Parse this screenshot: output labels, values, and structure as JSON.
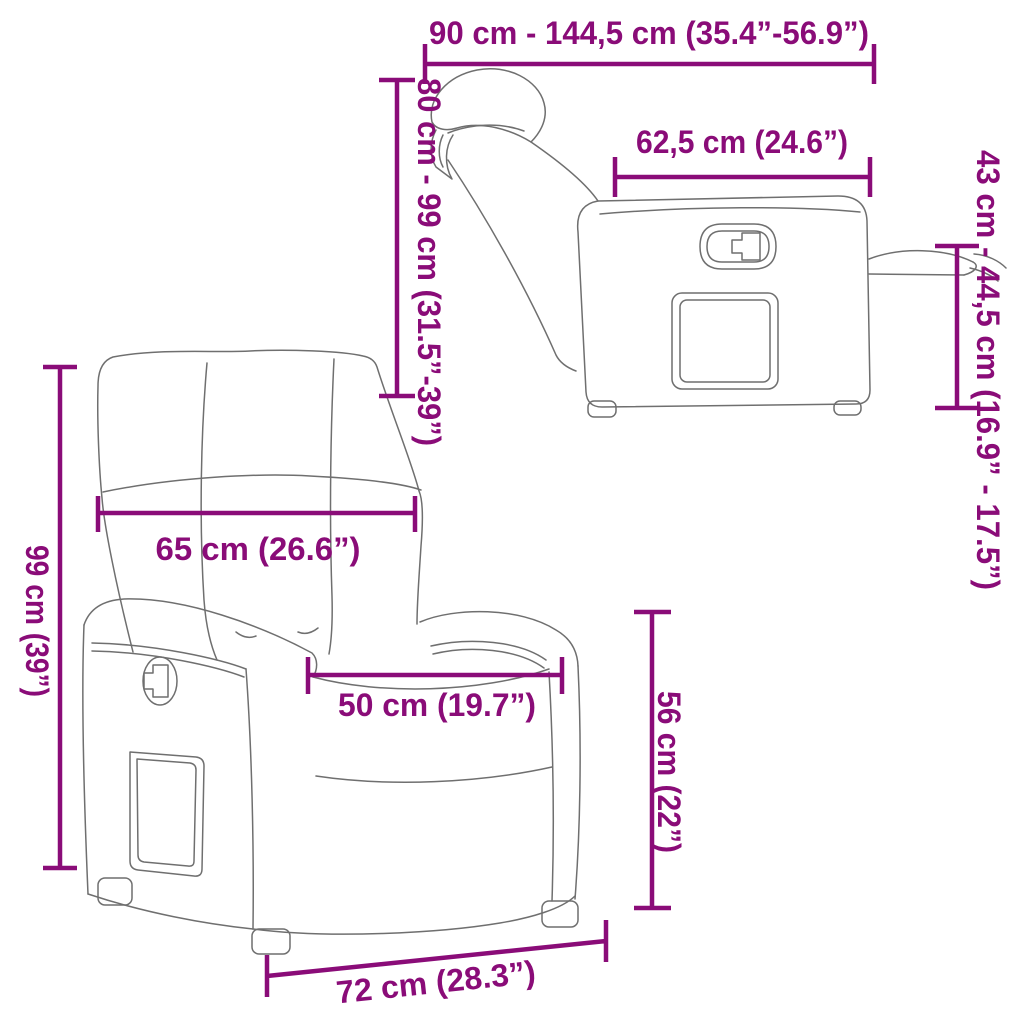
{
  "colors": {
    "accent": "#8a0c78",
    "line_art": "#6f6f6f",
    "background": "#ffffff"
  },
  "side_view": {
    "dims": {
      "length_range": "90 cm - 144,5 cm (35.4”-56.9”)",
      "height_range": "80 cm - 99 cm (31.5”-39”)",
      "seat_depth": "62,5 cm (24.6”)",
      "footrest_height_range": "43 cm - 44,5 cm (16.9” - 17.5”)"
    }
  },
  "front_view": {
    "dims": {
      "backrest_width": "65 cm (26.6”)",
      "total_height": "99 cm (39”)",
      "seat_width": "50 cm (19.7”)",
      "seat_height": "56 cm (22”)",
      "base_width": "72 cm (28.3”)"
    }
  }
}
